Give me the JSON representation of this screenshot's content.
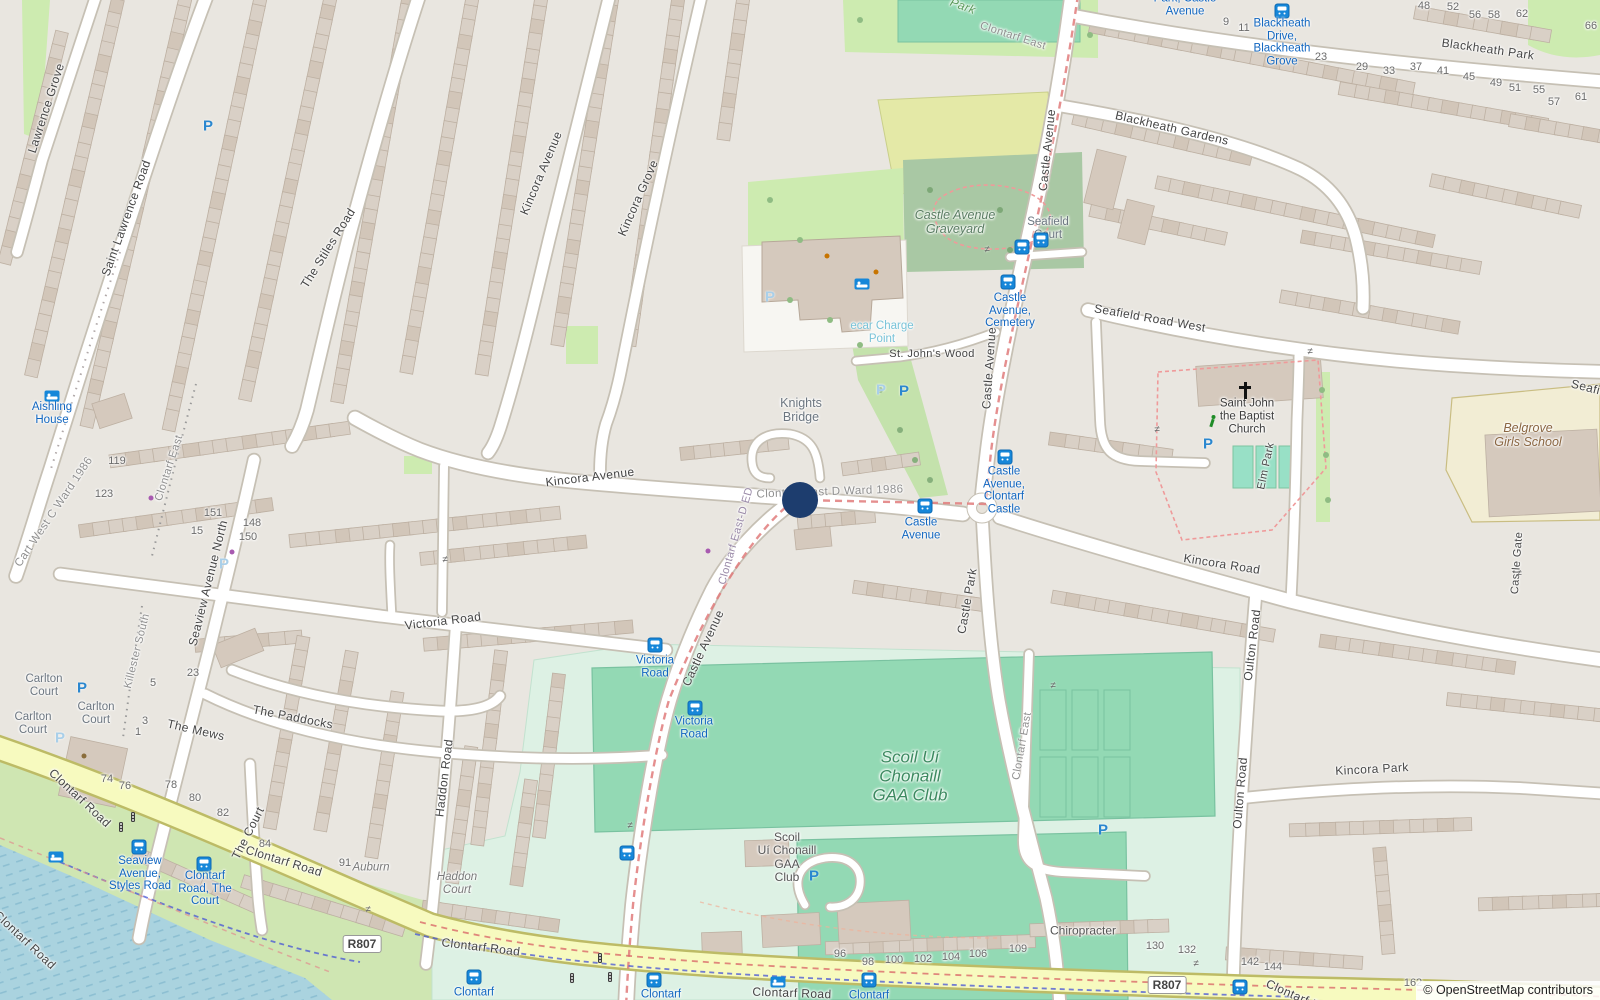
{
  "map": {
    "attribution": "© OpenStreetMap contributors"
  },
  "colors": {
    "bus_blue": "#1166c0",
    "road_yellow": "#f7fabf",
    "water": "#aad3df",
    "pitch_green": "#93d9b4",
    "park_green": "#cdebb0",
    "cemetery_green": "#a9c8a4",
    "marker_navy": "#1d3d6e",
    "boundary_red": "#e07b7b",
    "school_yellow": "#f2edd4"
  },
  "marker": {
    "x": 800,
    "y": 500,
    "r": 18,
    "color": "#1d3d6e"
  },
  "badges": [
    {
      "text": "R807",
      "x": 362,
      "y": 944
    },
    {
      "text": "R807",
      "x": 1167,
      "y": 985
    }
  ],
  "street_labels": [
    {
      "t": "Lawrence Grove",
      "x": 46,
      "y": 108,
      "r": -72
    },
    {
      "t": "Saint Lawrence Road",
      "x": 126,
      "y": 218,
      "r": -70
    },
    {
      "t": "The Stiles Road",
      "x": 328,
      "y": 248,
      "r": -58
    },
    {
      "t": "Kincora Avenue",
      "x": 541,
      "y": 173,
      "r": -67
    },
    {
      "t": "Kincora Grove",
      "x": 638,
      "y": 198,
      "r": -66
    },
    {
      "t": "Kincora Avenue",
      "x": 590,
      "y": 477,
      "r": -7
    },
    {
      "t": "Victoria Road",
      "x": 443,
      "y": 621,
      "r": -7
    },
    {
      "t": "Castle Avenue",
      "x": 1047,
      "y": 150,
      "r": -84
    },
    {
      "t": "Castle Avenue",
      "x": 989,
      "y": 368,
      "r": -86
    },
    {
      "t": "Castle Avenue",
      "x": 703,
      "y": 648,
      "r": -65
    },
    {
      "t": "Blackheath Park",
      "x": 1488,
      "y": 49,
      "r": 8
    },
    {
      "t": "Blackheath Gardens",
      "x": 1172,
      "y": 128,
      "r": 13
    },
    {
      "t": "Seafield Road West",
      "x": 1150,
      "y": 318,
      "r": 10
    },
    {
      "t": "Seafield",
      "x": 1594,
      "y": 389,
      "r": 14
    },
    {
      "t": "St. John's Wood",
      "x": 932,
      "y": 354,
      "r": 0,
      "s": 11
    },
    {
      "t": "Kincora Road",
      "x": 1222,
      "y": 564,
      "r": 9
    },
    {
      "t": "Kincora Park",
      "x": 1372,
      "y": 769,
      "r": -3
    },
    {
      "t": "Oulton Road",
      "x": 1252,
      "y": 645,
      "r": -83
    },
    {
      "t": "Oulton Road",
      "x": 1240,
      "y": 793,
      "r": -85
    },
    {
      "t": "Castle Park",
      "x": 967,
      "y": 601,
      "r": -80
    },
    {
      "t": "Clontarf East",
      "x": 1022,
      "y": 746,
      "r": -80,
      "c": "#8f8f8f",
      "s": 11
    },
    {
      "t": "Clontarf East",
      "x": 1013,
      "y": 36,
      "r": 18,
      "c": "#8f8f8f",
      "s": 11
    },
    {
      "t": "Clontarf East",
      "x": 169,
      "y": 468,
      "r": -72,
      "c": "#8f8f8f",
      "s": 11
    },
    {
      "t": "Elm Park",
      "x": 1266,
      "y": 466,
      "r": -78,
      "s": 11
    },
    {
      "t": "Castle Gate",
      "x": 1517,
      "y": 563,
      "r": -86,
      "s": 11
    },
    {
      "t": "Seaview Avenue North",
      "x": 208,
      "y": 583,
      "r": -76
    },
    {
      "t": "Haddon Road",
      "x": 444,
      "y": 778,
      "r": -83
    },
    {
      "t": "The Mews",
      "x": 196,
      "y": 730,
      "r": 13
    },
    {
      "t": "The Paddocks",
      "x": 293,
      "y": 717,
      "r": 11
    },
    {
      "t": "The Court",
      "x": 248,
      "y": 833,
      "r": -63
    },
    {
      "t": "Clontarf Road",
      "x": 80,
      "y": 798,
      "r": 43
    },
    {
      "t": "Clontarf Road",
      "x": 284,
      "y": 861,
      "r": 17
    },
    {
      "t": "Clontarf Road",
      "x": 481,
      "y": 947,
      "r": 7
    },
    {
      "t": "Clontarf Road",
      "x": 792,
      "y": 993,
      "r": 2
    },
    {
      "t": "Clontarf Road",
      "x": 25,
      "y": 940,
      "r": 43
    },
    {
      "t": "Clontarf Road",
      "x": 1303,
      "y": 999,
      "r": 24
    },
    {
      "t": "Killester South",
      "x": 137,
      "y": 651,
      "r": -76,
      "c": "#8f8f8f",
      "s": 11
    },
    {
      "t": "Cart West C Ward 1986",
      "x": 54,
      "y": 512,
      "r": -56,
      "c": "#8f8f8f",
      "s": 11.5
    },
    {
      "t": "Clontarf East D Ward 1986",
      "x": 830,
      "y": 492,
      "r": -2,
      "c": "#8f8f8f",
      "s": 11.5
    },
    {
      "t": "Clontarf East-D ED",
      "x": 736,
      "y": 536,
      "r": -74,
      "c": "#9a8aa8",
      "s": 11
    },
    {
      "t": "Park",
      "x": 963,
      "y": 6,
      "r": 20,
      "c": "#5a9a5a",
      "s": 12,
      "i": 1
    }
  ],
  "place_labels": [
    {
      "lines": [
        "Castle Avenue",
        "Graveyard"
      ],
      "x": 955,
      "y": 222,
      "c": "#5a7d62",
      "s": 12.5,
      "i": 1
    },
    {
      "lines": [
        "Knights",
        "Bridge"
      ],
      "x": 801,
      "y": 410,
      "c": "#6c7680",
      "s": 12.5
    },
    {
      "lines": [
        "Seafield",
        "Court"
      ],
      "x": 1048,
      "y": 229,
      "c": "#6c7680"
    },
    {
      "lines": [
        "Carlton",
        "Court"
      ],
      "x": 44,
      "y": 686,
      "c": "#6c7680"
    },
    {
      "lines": [
        "Carlton",
        "Court"
      ],
      "x": 96,
      "y": 714,
      "c": "#6c7680"
    },
    {
      "lines": [
        "Carlton",
        "Court"
      ],
      "x": 33,
      "y": 724,
      "c": "#6c7680"
    },
    {
      "lines": [
        "Auburn"
      ],
      "x": 371,
      "y": 868,
      "c": "#7a7a7a",
      "i": 1
    },
    {
      "lines": [
        "Haddon",
        "Court"
      ],
      "x": 457,
      "y": 884,
      "c": "#7a7a7a",
      "i": 1
    },
    {
      "lines": [
        "Chiropracter"
      ],
      "x": 1083,
      "y": 931,
      "c": "#555555",
      "s": 12
    },
    {
      "lines": [
        "Scoil Uí",
        "Chonaill",
        "GAA Club"
      ],
      "x": 910,
      "y": 776,
      "c": "#3c8a60",
      "s": 17,
      "i": 1
    },
    {
      "lines": [
        "Scoil",
        "Uí Chonaill",
        "GAA",
        "Club"
      ],
      "x": 787,
      "y": 858,
      "c": "#555555",
      "s": 12
    },
    {
      "lines": [
        "Aishling",
        "House"
      ],
      "x": 52,
      "y": 414,
      "c": "#1166c0"
    },
    {
      "lines": [
        "Belgrove",
        "Girls School"
      ],
      "x": 1528,
      "y": 435,
      "c": "#8a6642",
      "s": 12.5,
      "i": 1
    },
    {
      "lines": [
        "Saint John",
        "the Baptist",
        "Church"
      ],
      "x": 1247,
      "y": 417,
      "c": "#3d3d3d"
    },
    {
      "lines": [
        "ecar Charge",
        "Point"
      ],
      "x": 882,
      "y": 333,
      "c": "#79c3d8"
    }
  ],
  "bus_stops": [
    {
      "lines": [
        "Castle",
        "Avenue,",
        "Cemetery"
      ],
      "x": 1010,
      "y": 311,
      "icons": [
        [
          1022,
          247
        ],
        [
          1041,
          240
        ],
        [
          1008,
          282
        ]
      ]
    },
    {
      "lines": [
        "Blackheath",
        "Drive,",
        "Blackheath",
        "Grove"
      ],
      "x": 1282,
      "y": 43,
      "icons": [
        [
          1282,
          11
        ]
      ]
    },
    {
      "lines": [
        "Park, Castle",
        "Avenue"
      ],
      "x": 1185,
      "y": 5,
      "icons": []
    },
    {
      "lines": [
        "Castle",
        "Avenue"
      ],
      "x": 921,
      "y": 529,
      "icons": [
        [
          925,
          506
        ]
      ]
    },
    {
      "lines": [
        "Castle",
        "Avenue,",
        "Clontarf",
        "Castle"
      ],
      "x": 1004,
      "y": 491,
      "icons": [
        [
          1005,
          457
        ]
      ]
    },
    {
      "lines": [
        "Victoria",
        "Road"
      ],
      "x": 655,
      "y": 667,
      "icons": [
        [
          655,
          645
        ]
      ]
    },
    {
      "lines": [
        "Victoria",
        "Road"
      ],
      "x": 694,
      "y": 728,
      "icons": [
        [
          695,
          708
        ]
      ]
    },
    {
      "lines": [
        "Seaview",
        "Avenue,",
        "Styles Road"
      ],
      "x": 140,
      "y": 874,
      "icons": [
        [
          139,
          847
        ]
      ]
    },
    {
      "lines": [
        "Clontarf",
        "Road, The",
        "Court"
      ],
      "x": 205,
      "y": 889,
      "icons": [
        [
          204,
          864
        ]
      ]
    },
    {
      "lines": [
        "Clontarf"
      ],
      "x": 474,
      "y": 993,
      "icons": [
        [
          474,
          977
        ]
      ]
    },
    {
      "lines": [
        "Clontarf"
      ],
      "x": 661,
      "y": 995,
      "icons": [
        [
          654,
          980
        ]
      ]
    },
    {
      "lines": [
        "Clontarf"
      ],
      "x": 869,
      "y": 996,
      "icons": [
        [
          869,
          980
        ]
      ]
    },
    {
      "lines": [],
      "x": 1240,
      "y": 987,
      "icons": [
        [
          1240,
          987
        ]
      ]
    },
    {
      "lines": [],
      "x": 627,
      "y": 853,
      "icons": [
        [
          627,
          853
        ]
      ]
    }
  ],
  "parking": [
    {
      "x": 208,
      "y": 126
    },
    {
      "x": 770,
      "y": 297,
      "f": 1
    },
    {
      "x": 881,
      "y": 390,
      "f": 1
    },
    {
      "x": 904,
      "y": 391
    },
    {
      "x": 1208,
      "y": 444
    },
    {
      "x": 82,
      "y": 688
    },
    {
      "x": 60,
      "y": 738,
      "f": 1
    },
    {
      "x": 224,
      "y": 564,
      "f": 1
    },
    {
      "x": 814,
      "y": 876
    },
    {
      "x": 1103,
      "y": 830
    }
  ],
  "poi_icons": {
    "beds": [
      [
        862,
        284
      ],
      [
        52,
        396
      ],
      [
        778,
        982
      ],
      [
        56,
        857
      ]
    ],
    "cross": [
      [
        1245,
        391
      ]
    ],
    "runner": [
      [
        1213,
        421
      ]
    ],
    "traffic_lights": [
      [
        121,
        827
      ],
      [
        133,
        817
      ],
      [
        572,
        978
      ],
      [
        600,
        958
      ],
      [
        610,
        977
      ]
    ],
    "gates": [
      [
        987,
        250
      ],
      [
        445,
        560
      ],
      [
        1310,
        352
      ],
      [
        1157,
        430
      ],
      [
        1519,
        574
      ],
      [
        630,
        826
      ],
      [
        368,
        910
      ],
      [
        1053,
        686
      ],
      [
        1196,
        964
      ]
    ],
    "shop_dots": [
      [
        151,
        498
      ],
      [
        232,
        552
      ],
      [
        708,
        551
      ]
    ],
    "food_dots": [
      [
        827,
        256
      ],
      [
        876,
        272
      ]
    ],
    "misc_dots": [
      [
        84,
        756
      ]
    ]
  },
  "house_numbers": [
    {
      "n": "9",
      "x": 1226,
      "y": 22
    },
    {
      "n": "11",
      "x": 1244,
      "y": 28
    },
    {
      "n": "48",
      "x": 1424,
      "y": 6
    },
    {
      "n": "52",
      "x": 1453,
      "y": 7
    },
    {
      "n": "56",
      "x": 1475,
      "y": 15
    },
    {
      "n": "58",
      "x": 1494,
      "y": 15
    },
    {
      "n": "62",
      "x": 1522,
      "y": 14
    },
    {
      "n": "66",
      "x": 1591,
      "y": 26
    },
    {
      "n": "23",
      "x": 1321,
      "y": 57
    },
    {
      "n": "29",
      "x": 1362,
      "y": 67
    },
    {
      "n": "33",
      "x": 1389,
      "y": 71
    },
    {
      "n": "37",
      "x": 1416,
      "y": 67
    },
    {
      "n": "41",
      "x": 1443,
      "y": 71
    },
    {
      "n": "45",
      "x": 1469,
      "y": 77
    },
    {
      "n": "49",
      "x": 1496,
      "y": 83
    },
    {
      "n": "51",
      "x": 1515,
      "y": 88
    },
    {
      "n": "55",
      "x": 1539,
      "y": 90
    },
    {
      "n": "57",
      "x": 1554,
      "y": 102
    },
    {
      "n": "61",
      "x": 1581,
      "y": 97
    },
    {
      "n": "119",
      "x": 117,
      "y": 461
    },
    {
      "n": "123",
      "x": 104,
      "y": 494
    },
    {
      "n": "151",
      "x": 213,
      "y": 513
    },
    {
      "n": "148",
      "x": 252,
      "y": 523
    },
    {
      "n": "150",
      "x": 248,
      "y": 537
    },
    {
      "n": "15",
      "x": 197,
      "y": 531
    },
    {
      "n": "23",
      "x": 193,
      "y": 673
    },
    {
      "n": "5",
      "x": 153,
      "y": 683
    },
    {
      "n": "3",
      "x": 145,
      "y": 721
    },
    {
      "n": "1",
      "x": 138,
      "y": 732
    },
    {
      "n": "74",
      "x": 107,
      "y": 779
    },
    {
      "n": "76",
      "x": 125,
      "y": 786
    },
    {
      "n": "78",
      "x": 171,
      "y": 785
    },
    {
      "n": "80",
      "x": 195,
      "y": 798
    },
    {
      "n": "82",
      "x": 223,
      "y": 813
    },
    {
      "n": "84",
      "x": 265,
      "y": 844
    },
    {
      "n": "91",
      "x": 345,
      "y": 863
    },
    {
      "n": "96",
      "x": 840,
      "y": 954
    },
    {
      "n": "98",
      "x": 868,
      "y": 962
    },
    {
      "n": "100",
      "x": 894,
      "y": 960
    },
    {
      "n": "102",
      "x": 923,
      "y": 959
    },
    {
      "n": "104",
      "x": 951,
      "y": 957
    },
    {
      "n": "106",
      "x": 978,
      "y": 954
    },
    {
      "n": "109",
      "x": 1018,
      "y": 949
    },
    {
      "n": "130",
      "x": 1155,
      "y": 946
    },
    {
      "n": "132",
      "x": 1187,
      "y": 950
    },
    {
      "n": "142",
      "x": 1250,
      "y": 962
    },
    {
      "n": "144",
      "x": 1273,
      "y": 967
    },
    {
      "n": "162",
      "x": 1413,
      "y": 983
    }
  ]
}
